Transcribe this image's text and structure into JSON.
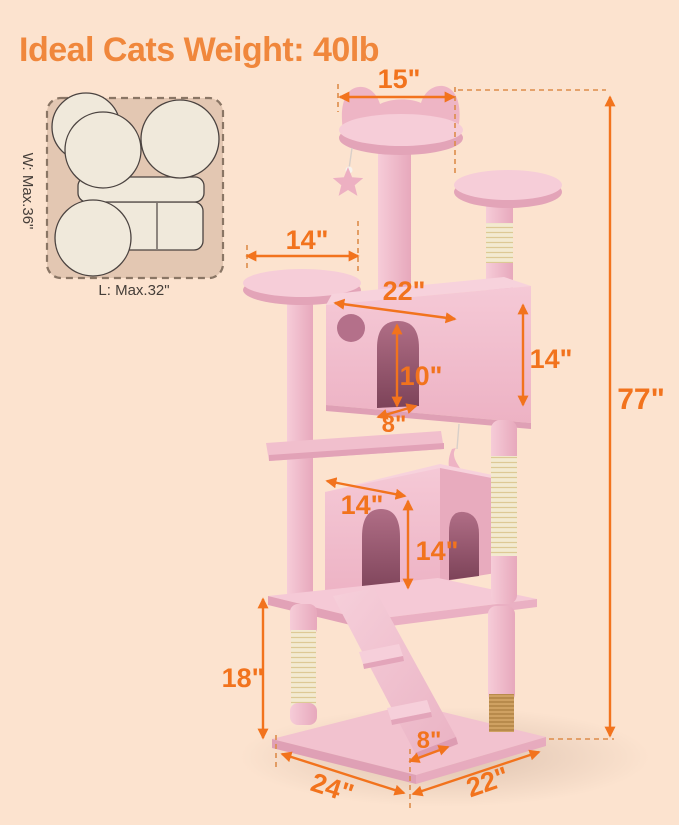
{
  "title": "Ideal Cats Weight: 40lb",
  "footprint_diagram": {
    "width_label": "W: Max.36\"",
    "length_label": "L: Max.32\""
  },
  "dimensions": {
    "total_height": "77\"",
    "top_perch_width": "15\"",
    "upper_platform_width": "14\"",
    "top_condo_width": "22\"",
    "top_condo_height": "14\"",
    "top_condo_door_height": "10\"",
    "top_condo_door_width": "8\"",
    "lower_condo_width": "14\"",
    "lower_condo_height": "14\"",
    "bottom_height": "18\"",
    "ramp_width": "8\"",
    "base_length": "24\"",
    "base_width": "22\""
  },
  "colors": {
    "background": "#fce3cf",
    "title_orange": "#f0873c",
    "dimension_orange": "#f2731d",
    "tree_pink": "#f3c3d0",
    "sisal_cream": "#f3ead0",
    "sisal_tan": "#cfa162",
    "footprint_tan": "#e3c7b2"
  }
}
